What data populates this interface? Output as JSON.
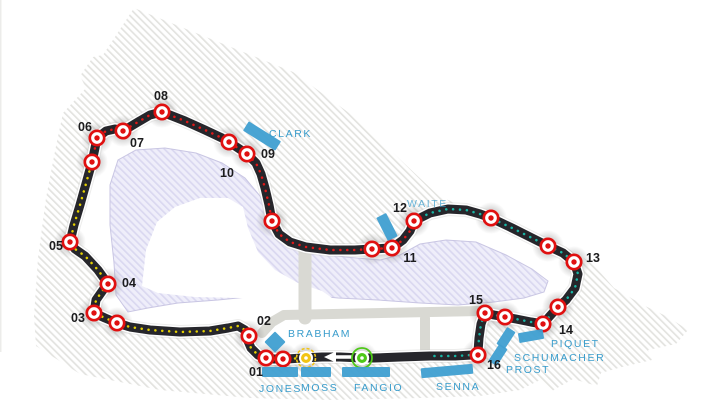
{
  "map_kind": "circuit-track-map",
  "colors": {
    "track": "#26262b",
    "track_casing": "#ffffff",
    "track_shadow": "#c9c9c5",
    "sector1_yellow": "#e3cf00",
    "sector2_red": "#e01818",
    "sector3_teal": "#17b5a4",
    "marker_red": "#e01010",
    "label_dark": "#1c1c1e",
    "stand_bar_blue": "#3f9fd1",
    "stand_text_blue": "#3a9dcc",
    "park_hatch_line": "#e3e3e0",
    "lake_fill": "#efeefa",
    "lake_hatch_line": "#dad8f0",
    "lake_border": "#c9c6e3",
    "road_gray": "#d9d9d3",
    "pole_yellow": "#f2c413",
    "start_green": "#4ec818",
    "arrow_white": "#ffffff",
    "halo_gray": "#787878"
  },
  "corner_labels": [
    {
      "text": "01",
      "x": 256,
      "y": 376
    },
    {
      "text": "02",
      "x": 264,
      "y": 325
    },
    {
      "text": "03",
      "x": 78,
      "y": 322
    },
    {
      "text": "04",
      "x": 129,
      "y": 287
    },
    {
      "text": "05",
      "x": 56,
      "y": 250
    },
    {
      "text": "06",
      "x": 85,
      "y": 131
    },
    {
      "text": "07",
      "x": 137,
      "y": 147
    },
    {
      "text": "08",
      "x": 161,
      "y": 100
    },
    {
      "text": "09",
      "x": 268,
      "y": 158
    },
    {
      "text": "10",
      "x": 227,
      "y": 177
    },
    {
      "text": "11",
      "x": 410,
      "y": 262
    },
    {
      "text": "12",
      "x": 400,
      "y": 212
    },
    {
      "text": "13",
      "x": 593,
      "y": 262
    },
    {
      "text": "14",
      "x": 566,
      "y": 334
    },
    {
      "text": "15",
      "x": 476,
      "y": 304
    },
    {
      "text": "16",
      "x": 494,
      "y": 369
    }
  ],
  "corner_markers": [
    [
      283,
      359
    ],
    [
      266,
      358
    ],
    [
      249,
      336
    ],
    [
      117,
      323
    ],
    [
      94,
      313
    ],
    [
      108,
      284
    ],
    [
      70,
      242
    ],
    [
      92,
      162
    ],
    [
      97,
      138
    ],
    [
      123,
      131
    ],
    [
      162,
      112
    ],
    [
      229,
      142
    ],
    [
      247,
      154
    ],
    [
      272,
      221
    ],
    [
      372,
      249
    ],
    [
      392,
      248
    ],
    [
      414,
      221
    ],
    [
      491,
      218
    ],
    [
      548,
      246
    ],
    [
      574,
      262
    ],
    [
      558,
      307
    ],
    [
      543,
      324
    ],
    [
      505,
      317
    ],
    [
      485,
      313
    ],
    [
      478,
      355
    ]
  ],
  "special_markers": {
    "pole_position": {
      "x": 306,
      "y": 358
    },
    "start_finish": {
      "x": 362,
      "y": 358
    }
  },
  "direction_arrow": {
    "tip_x": 324,
    "tail_x": 352,
    "y": 357
  },
  "grandstands": [
    {
      "name": "CLARK",
      "label": {
        "x": 269,
        "y": 137
      },
      "bar": {
        "cx": 262,
        "cy": 136,
        "w": 38,
        "h": 11,
        "angle": 32
      }
    },
    {
      "name": "WAITE",
      "label": {
        "x": 407,
        "y": 207
      },
      "muted": true,
      "bar": {
        "cx": 387,
        "cy": 227,
        "w": 26,
        "h": 11,
        "angle": 63
      }
    },
    {
      "name": "BRABHAM",
      "label": {
        "x": 288,
        "y": 337
      },
      "bar": {
        "cx": 275,
        "cy": 342,
        "w": 15,
        "h": 15,
        "angle": 45
      }
    },
    {
      "name": "JONES",
      "label": {
        "x": 259,
        "y": 392
      },
      "bar": {
        "cx": 280,
        "cy": 372,
        "w": 36,
        "h": 10,
        "angle": 0
      }
    },
    {
      "name": "MOSS",
      "label": {
        "x": 301,
        "y": 391
      },
      "bar": {
        "cx": 316,
        "cy": 372,
        "w": 30,
        "h": 10,
        "angle": 0
      }
    },
    {
      "name": "FANGIO",
      "label": {
        "x": 354,
        "y": 391
      },
      "bar": {
        "cx": 366,
        "cy": 372,
        "w": 48,
        "h": 10,
        "angle": 0
      }
    },
    {
      "name": "SENNA",
      "label": {
        "x": 436,
        "y": 390
      },
      "bar": {
        "cx": 447,
        "cy": 371,
        "w": 52,
        "h": 10,
        "angle": -5
      }
    },
    {
      "name": "PROST",
      "label": {
        "x": 506,
        "y": 373
      },
      "bar": {
        "cx": 498,
        "cy": 355,
        "w": 20,
        "h": 10,
        "angle": -57
      }
    },
    {
      "name": "SCHUMACHER",
      "label": {
        "x": 514,
        "y": 361
      },
      "bar": {
        "cx": 506,
        "cy": 338,
        "w": 20,
        "h": 10,
        "angle": -57
      }
    },
    {
      "name": "PIQUET",
      "label": {
        "x": 551,
        "y": 347
      },
      "bar": {
        "cx": 531,
        "cy": 336,
        "w": 25,
        "h": 10,
        "angle": -10
      }
    }
  ],
  "track": {
    "loop": [
      [
        302,
        358
      ],
      [
        287,
        359
      ],
      [
        283,
        359
      ],
      [
        274,
        359
      ],
      [
        266,
        358
      ],
      [
        258,
        355
      ],
      [
        251,
        348
      ],
      [
        248,
        341
      ],
      [
        249,
        336
      ],
      [
        245,
        330
      ],
      [
        238,
        326
      ],
      [
        228,
        328
      ],
      [
        210,
        331
      ],
      [
        180,
        332
      ],
      [
        150,
        330
      ],
      [
        130,
        327
      ],
      [
        117,
        323
      ],
      [
        105,
        318
      ],
      [
        94,
        313
      ],
      [
        96,
        300
      ],
      [
        103,
        290
      ],
      [
        108,
        284
      ],
      [
        98,
        270
      ],
      [
        85,
        256
      ],
      [
        75,
        249
      ],
      [
        70,
        242
      ],
      [
        74,
        225
      ],
      [
        80,
        205
      ],
      [
        87,
        180
      ],
      [
        92,
        162
      ],
      [
        95,
        148
      ],
      [
        97,
        138
      ],
      [
        106,
        131
      ],
      [
        115,
        129
      ],
      [
        123,
        131
      ],
      [
        138,
        122
      ],
      [
        150,
        115
      ],
      [
        162,
        112
      ],
      [
        185,
        121
      ],
      [
        205,
        130
      ],
      [
        222,
        138
      ],
      [
        229,
        142
      ],
      [
        241,
        150
      ],
      [
        247,
        154
      ],
      [
        256,
        163
      ],
      [
        261,
        174
      ],
      [
        265,
        188
      ],
      [
        269,
        205
      ],
      [
        272,
        221
      ],
      [
        279,
        234
      ],
      [
        290,
        242
      ],
      [
        306,
        247
      ],
      [
        330,
        250
      ],
      [
        355,
        250
      ],
      [
        372,
        249
      ],
      [
        392,
        248
      ],
      [
        403,
        240
      ],
      [
        410,
        231
      ],
      [
        414,
        221
      ],
      [
        430,
        213
      ],
      [
        448,
        209
      ],
      [
        466,
        210
      ],
      [
        480,
        214
      ],
      [
        491,
        218
      ],
      [
        512,
        228
      ],
      [
        532,
        238
      ],
      [
        548,
        246
      ],
      [
        563,
        253
      ],
      [
        574,
        262
      ],
      [
        578,
        274
      ],
      [
        575,
        288
      ],
      [
        566,
        300
      ],
      [
        558,
        307
      ],
      [
        549,
        317
      ],
      [
        543,
        324
      ],
      [
        531,
        322
      ],
      [
        516,
        319
      ],
      [
        505,
        317
      ],
      [
        494,
        315
      ],
      [
        485,
        313
      ],
      [
        481,
        324
      ],
      [
        479,
        338
      ],
      [
        478,
        352
      ],
      [
        472,
        355
      ],
      [
        455,
        356
      ],
      [
        430,
        356
      ],
      [
        400,
        357
      ],
      [
        374,
        358
      ],
      [
        362,
        358
      ],
      [
        340,
        357
      ],
      [
        322,
        357
      ]
    ],
    "sector_ranges": {
      "yellow": [
        0,
        29
      ],
      "red": [
        29,
        58
      ],
      "teal": [
        58,
        85
      ]
    }
  },
  "outlines": {
    "park": [
      [
        134,
        8
      ],
      [
        293,
        72
      ],
      [
        356,
        118
      ],
      [
        440,
        197
      ],
      [
        517,
        225
      ],
      [
        560,
        244
      ],
      [
        592,
        263
      ],
      [
        614,
        288
      ],
      [
        643,
        305
      ],
      [
        668,
        317
      ],
      [
        688,
        330
      ],
      [
        676,
        344
      ],
      [
        648,
        350
      ],
      [
        652,
        360
      ],
      [
        622,
        367
      ],
      [
        601,
        373
      ],
      [
        597,
        386
      ],
      [
        573,
        379
      ],
      [
        552,
        391
      ],
      [
        540,
        380
      ],
      [
        520,
        390
      ],
      [
        480,
        396
      ],
      [
        420,
        398
      ],
      [
        330,
        400
      ],
      [
        250,
        398
      ],
      [
        160,
        390
      ],
      [
        80,
        374
      ],
      [
        36,
        346
      ],
      [
        34,
        316
      ],
      [
        38,
        258
      ],
      [
        46,
        198
      ],
      [
        56,
        146
      ],
      [
        63,
        113
      ],
      [
        86,
        88
      ],
      [
        80,
        76
      ],
      [
        93,
        57
      ],
      [
        103,
        55
      ]
    ],
    "lake": [
      [
        128,
        312
      ],
      [
        116,
        295
      ],
      [
        114,
        263
      ],
      [
        110,
        225
      ],
      [
        110,
        185
      ],
      [
        118,
        160
      ],
      [
        136,
        150
      ],
      [
        165,
        148
      ],
      [
        196,
        153
      ],
      [
        222,
        163
      ],
      [
        245,
        178
      ],
      [
        260,
        196
      ],
      [
        268,
        215
      ],
      [
        276,
        233
      ],
      [
        292,
        244
      ],
      [
        316,
        252
      ],
      [
        345,
        257
      ],
      [
        380,
        260
      ],
      [
        400,
        255
      ],
      [
        420,
        244
      ],
      [
        446,
        240
      ],
      [
        476,
        242
      ],
      [
        506,
        255
      ],
      [
        532,
        269
      ],
      [
        548,
        281
      ],
      [
        544,
        292
      ],
      [
        524,
        298
      ],
      [
        494,
        302
      ],
      [
        458,
        305
      ],
      [
        420,
        303
      ],
      [
        378,
        300
      ],
      [
        338,
        298
      ],
      [
        298,
        294
      ],
      [
        258,
        296
      ],
      [
        218,
        300
      ],
      [
        178,
        303
      ],
      [
        148,
        308
      ]
    ],
    "island": [
      [
        142,
        286
      ],
      [
        146,
        250
      ],
      [
        157,
        222
      ],
      [
        175,
        207
      ],
      [
        200,
        198
      ],
      [
        228,
        198
      ],
      [
        243,
        207
      ],
      [
        248,
        228
      ],
      [
        258,
        252
      ],
      [
        275,
        270
      ],
      [
        298,
        283
      ],
      [
        322,
        291
      ],
      [
        332,
        298
      ],
      [
        326,
        306
      ],
      [
        284,
        301
      ],
      [
        240,
        298
      ],
      [
        195,
        297
      ],
      [
        158,
        293
      ]
    ],
    "roads": [
      {
        "pts": [
          [
            305,
            250
          ],
          [
            305,
            318
          ]
        ],
        "w": 13
      },
      {
        "pts": [
          [
            262,
            333
          ],
          [
            272,
            322
          ],
          [
            284,
            315
          ],
          [
            480,
            311
          ]
        ],
        "w": 10
      },
      {
        "pts": [
          [
            425,
            318
          ],
          [
            425,
            350
          ]
        ],
        "w": 10
      }
    ]
  }
}
